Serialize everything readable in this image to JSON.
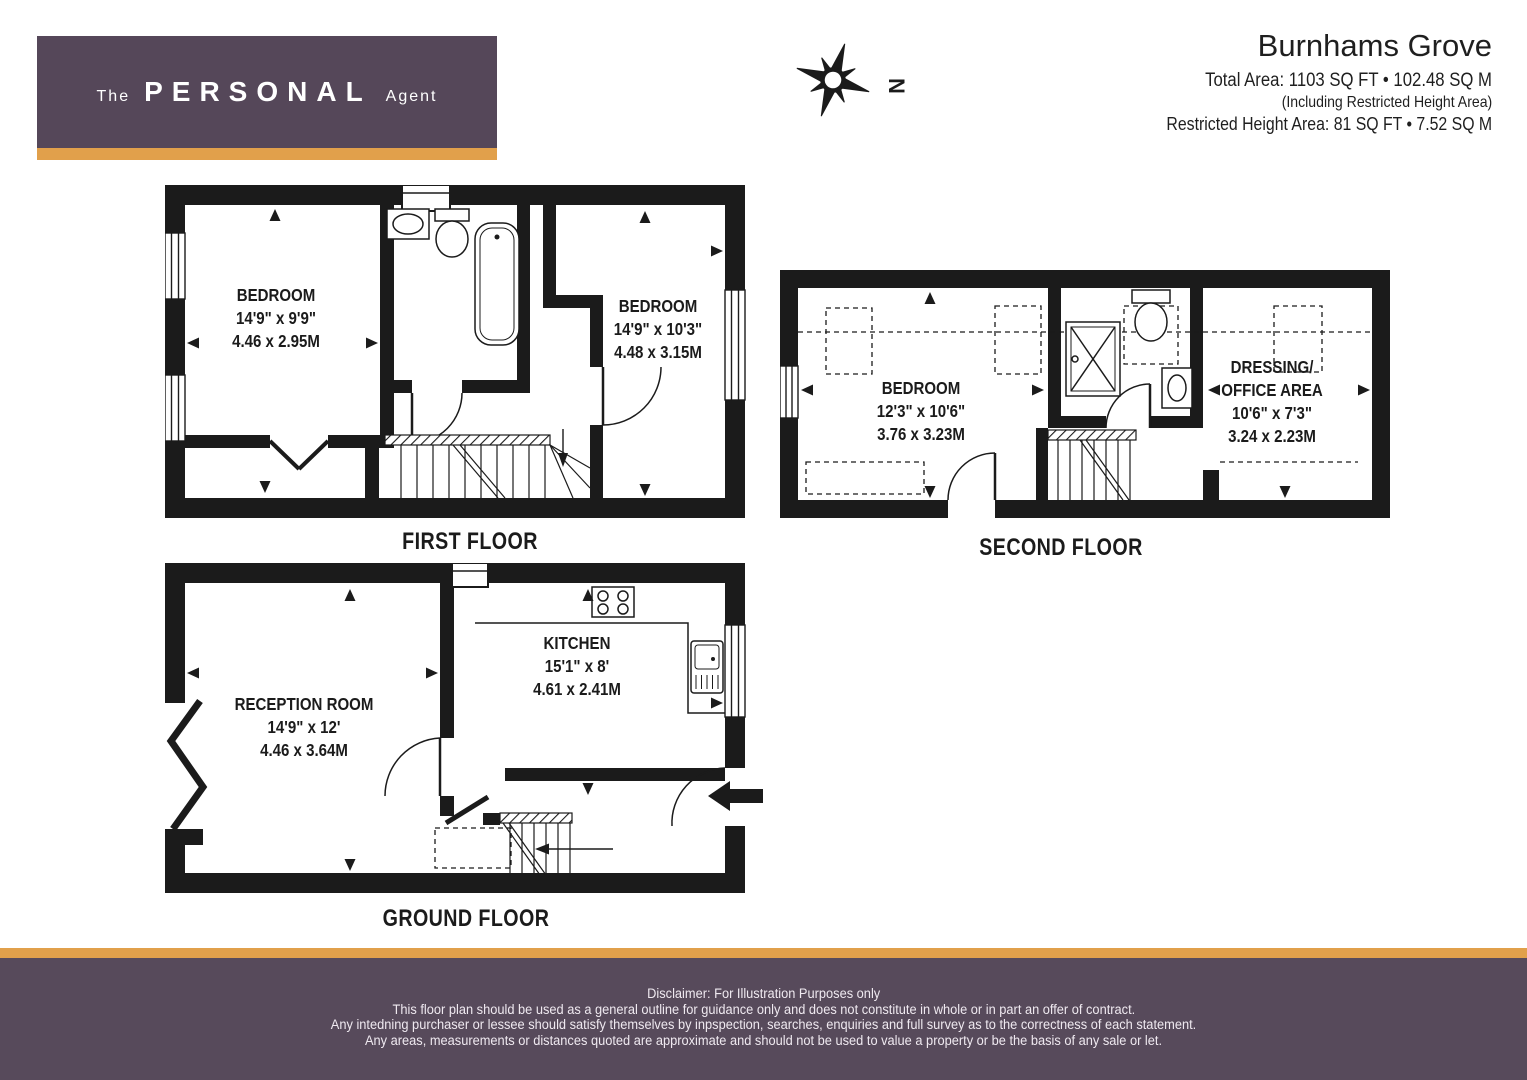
{
  "header": {
    "logo": {
      "the": "The",
      "personal": "PERSONAL",
      "agent": "Agent"
    },
    "property_name": "Burnhams Grove",
    "total_area": "Total Area: 1103 SQ FT • 102.48 SQ M",
    "including_note": "(Including Restricted Height Area)",
    "restricted_area": "Restricted Height Area: 81 SQ FT • 7.52 SQ M",
    "compass": {
      "label": "N"
    }
  },
  "colors": {
    "brand_purple": "#554759",
    "brand_orange": "#e1a04b",
    "plan_black": "#1b1b1b"
  },
  "floors": {
    "first": {
      "caption": "FIRST FLOOR",
      "rooms": [
        {
          "name": "BEDROOM",
          "imperial": "14'9\" x 9'9\"",
          "metric": "4.46 x 2.95M"
        },
        {
          "name": "BEDROOM",
          "imperial": "14'9\" x 10'3\"",
          "metric": "4.48 x 3.15M"
        }
      ]
    },
    "second": {
      "caption": "SECOND FLOOR",
      "rooms": [
        {
          "name": "BEDROOM",
          "imperial": "12'3\" x 10'6\"",
          "metric": "3.76 x 3.23M"
        },
        {
          "name": "DRESSING/",
          "name_line2": "OFFICE AREA",
          "imperial": "10'6\" x 7'3\"",
          "metric": "3.24 x 2.23M"
        }
      ]
    },
    "ground": {
      "caption": "GROUND FLOOR",
      "rooms": [
        {
          "name": "RECEPTION ROOM",
          "imperial": "14'9\" x 12'",
          "metric": "4.46 x 3.64M"
        },
        {
          "name": "KITCHEN",
          "imperial": "15'1\" x 8'",
          "metric": "4.61 x 2.41M"
        }
      ]
    }
  },
  "footer": {
    "lines": [
      "Disclaimer: For Illustration Purposes only",
      "This floor plan should be used as a general outline for guidance only and does not constitute in whole or in part an offer of contract.",
      "Any intedning purchaser or lessee should satisfy themselves by inpspection, searches, enquiries and full survey as to the correctness of each statement.",
      "Any areas, measurements or distances quoted are approximate and should not be used to value a property or be the basis of any sale or let."
    ]
  }
}
